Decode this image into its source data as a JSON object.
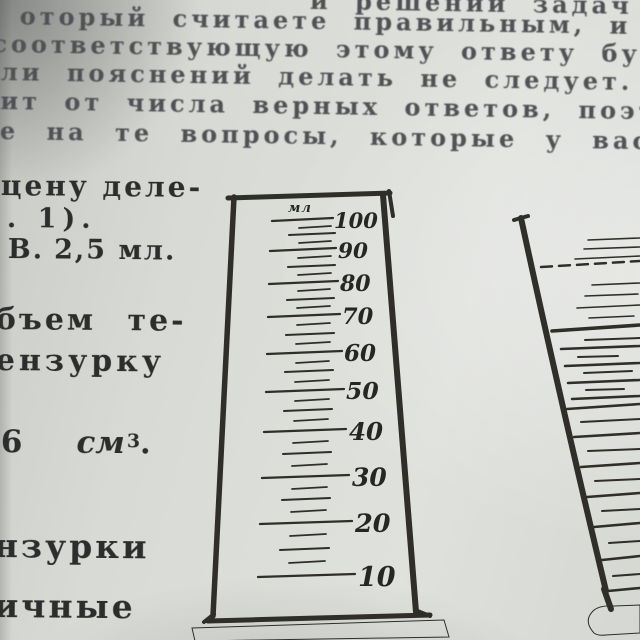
{
  "top_paragraph": {
    "lines": [
      "и решении задач и",
      "оторый считаете правильным, и на",
      "соответствующую этому ответу букв",
      "ли пояснений делать не следует.",
      "ит от числа верных ответов, поэтом",
      "е на те вопросы, которые у вас н"
    ]
  },
  "left_column": {
    "cena_fragment": "цену деле-",
    "ris_fragment": ". 1).",
    "answer_letter": "В.",
    "answer_value": "2,5 мл.",
    "obyem_fragment": "бъем те-",
    "menzurku_fragment": "ензурку",
    "volume_number": "6",
    "volume_unit": "см",
    "volume_exponent": "3",
    "volume_period": ".",
    "menzurki_fragment": "нзурки",
    "razlichnye_fragment": "ичные"
  },
  "left_cylinder": {
    "unit_label": "мл",
    "scale_labels": [
      "100",
      "90",
      "80",
      "70",
      "60",
      "50",
      "40",
      "30",
      "20",
      "10"
    ]
  },
  "colors": {
    "paper": "#d7d9d5",
    "ink_paragraph": "#4f5154",
    "ink_dark": "#2c2e2d",
    "figure_line": "#2f2e29"
  }
}
